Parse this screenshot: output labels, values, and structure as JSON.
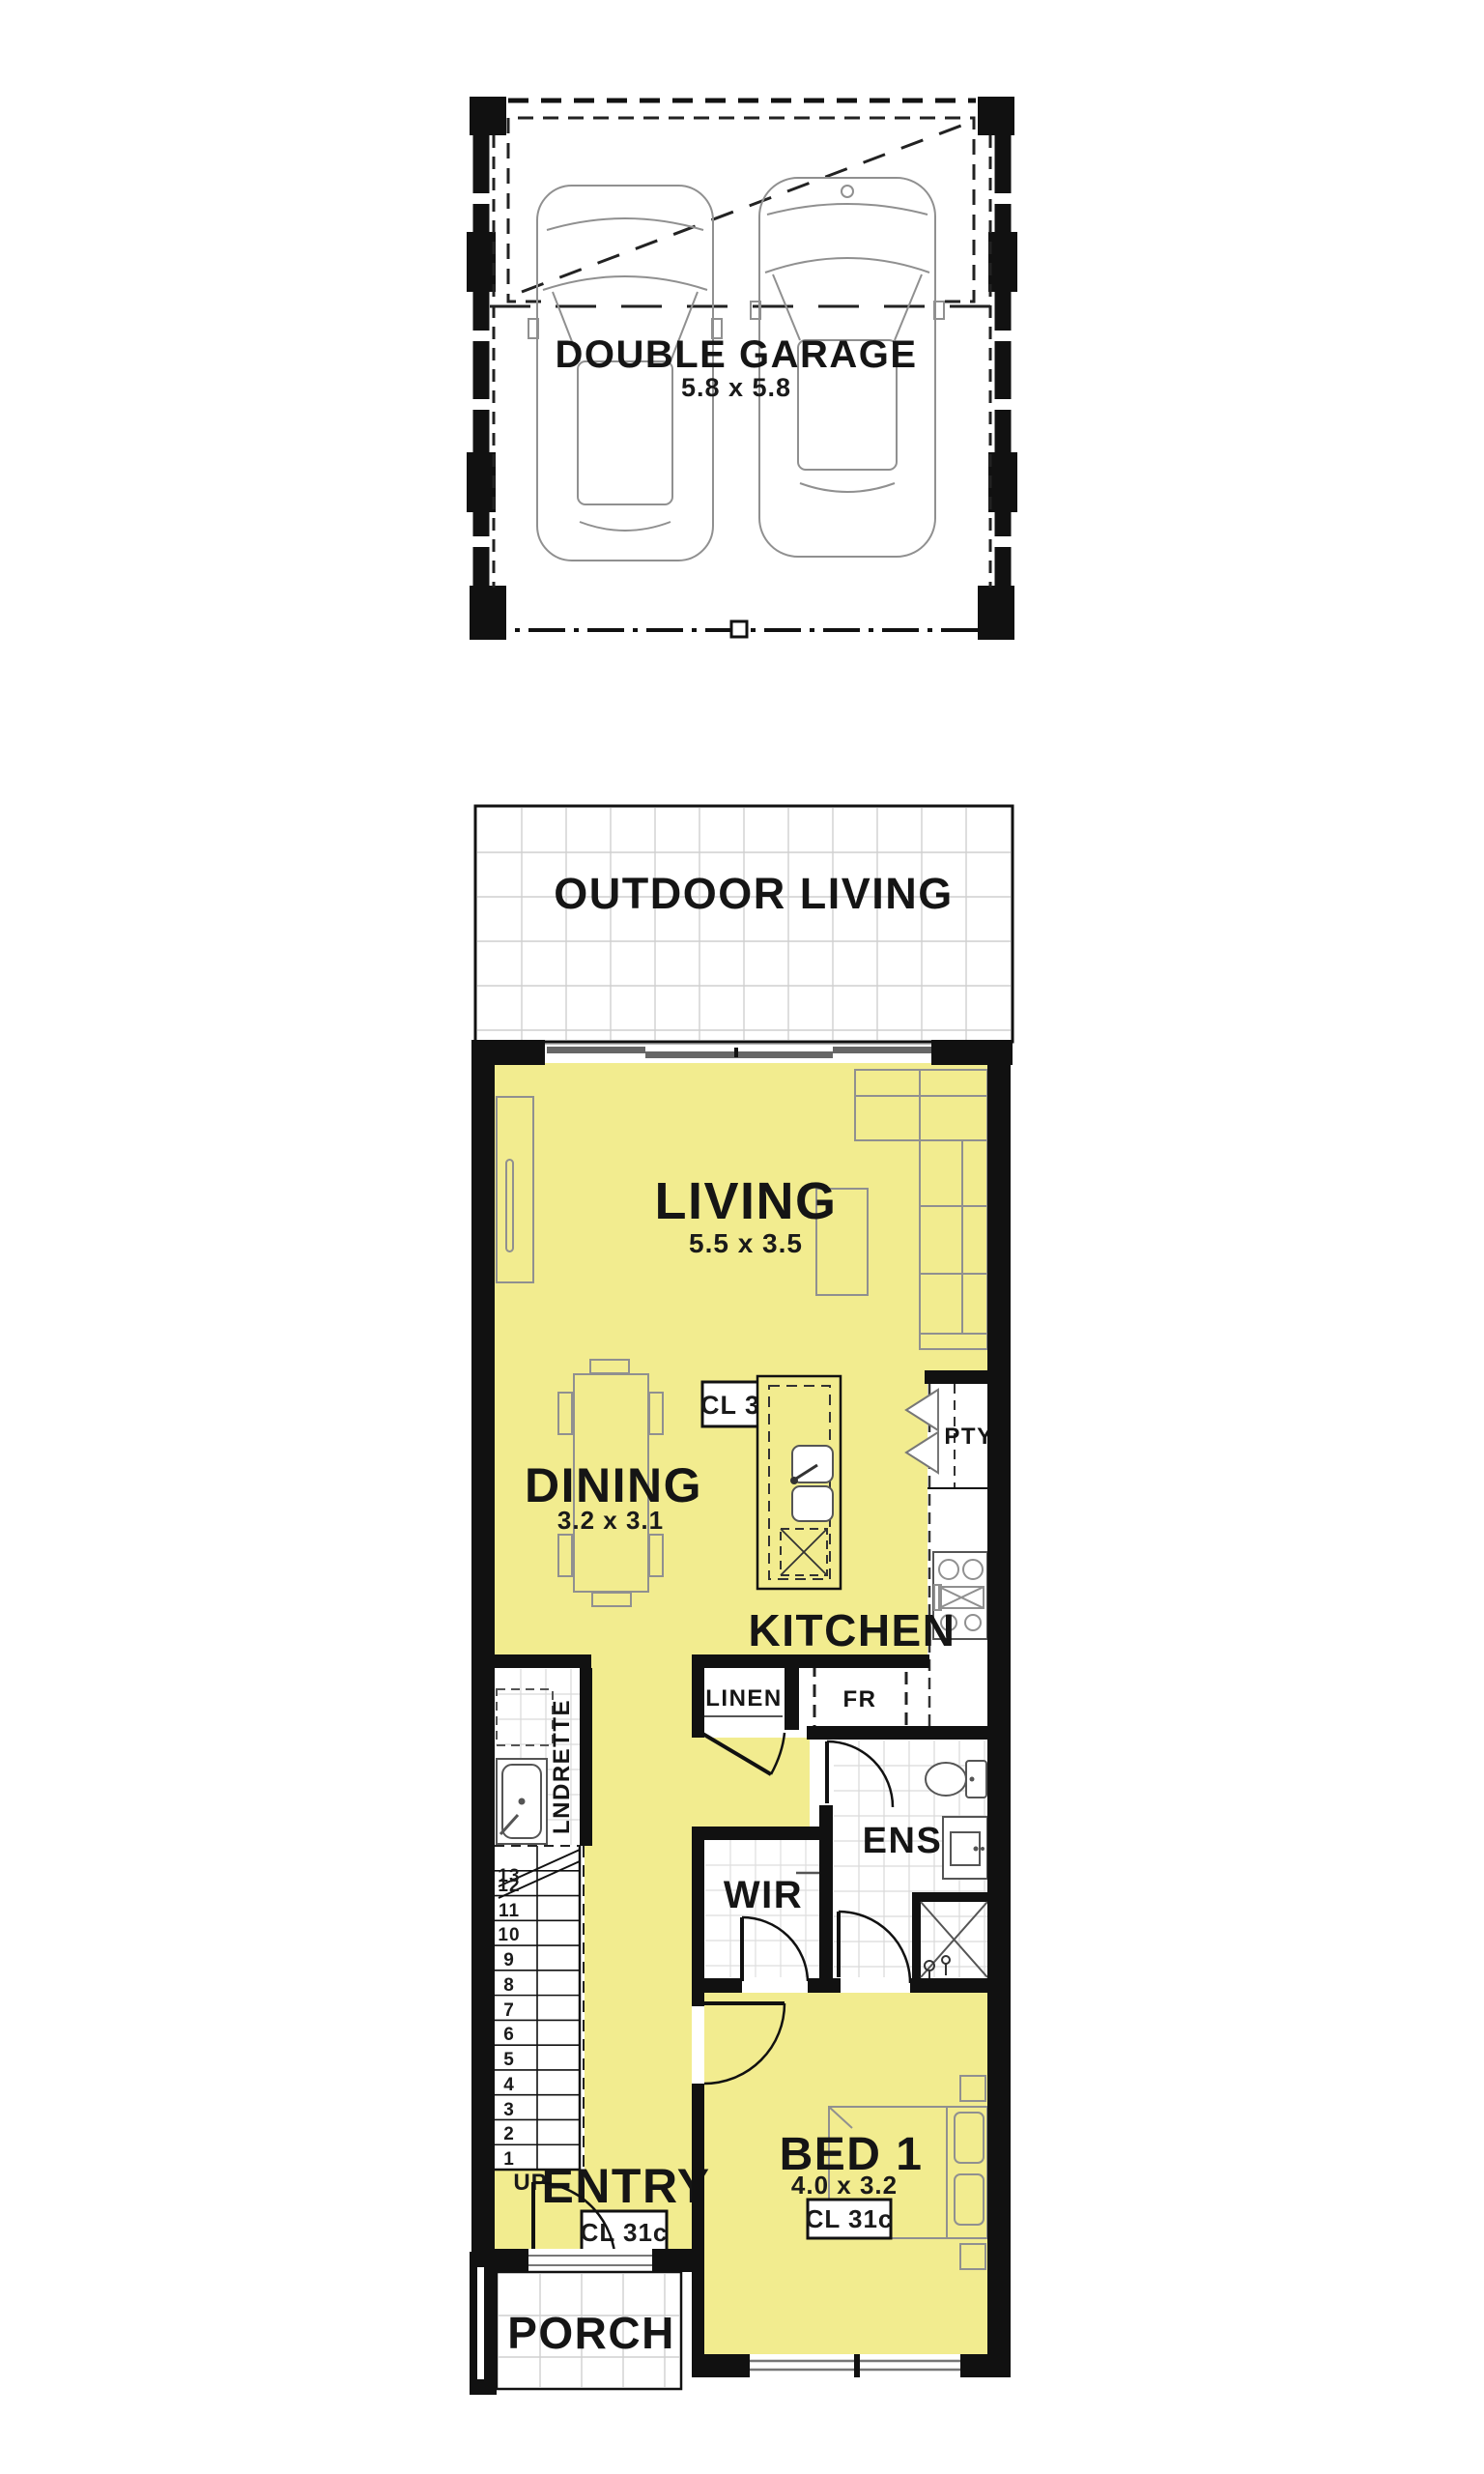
{
  "plan_title": "Single dwelling floor plan",
  "colors": {
    "floor_yellow": "#F2EC8F",
    "wall_black": "#111111",
    "furniture_gray": "#909090",
    "tile_gray": "#D9D9D9"
  },
  "garage": {
    "label": "DOUBLE GARAGE",
    "dims": "5.8 x 5.8"
  },
  "outdoor": {
    "label": "OUTDOOR LIVING"
  },
  "living": {
    "label": "LIVING",
    "dims": "5.5 x 3.5",
    "ceiling": "CL 31c"
  },
  "dining": {
    "label": "DINING",
    "dims": "3.2 x 3.1"
  },
  "kitchen": {
    "label": "KITCHEN",
    "pantry": "PTY",
    "fridge": "FR",
    "linen": "LINEN"
  },
  "laundry": {
    "label": "LNDRETTE"
  },
  "stairs": {
    "up": "UP",
    "steps": [
      "13",
      "12",
      "11",
      "10",
      "9",
      "8",
      "7",
      "6",
      "5",
      "4",
      "3",
      "2",
      "1"
    ]
  },
  "wir": {
    "label": "WIR"
  },
  "ens": {
    "label": "ENS"
  },
  "entry": {
    "label": "ENTRY",
    "ceiling": "CL 31c"
  },
  "bed1": {
    "label": "BED 1",
    "dims": "4.0 x 3.2",
    "ceiling": "CL 31c"
  },
  "porch": {
    "label": "PORCH"
  }
}
